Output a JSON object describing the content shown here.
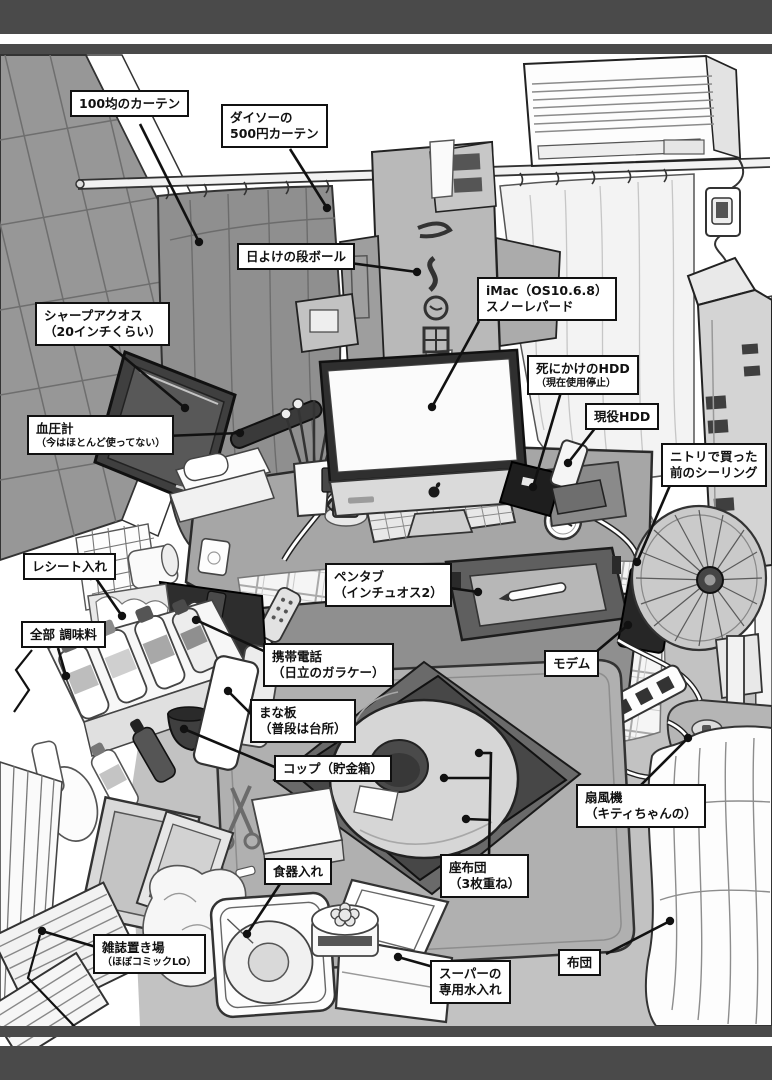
{
  "illustration_subject": "部屋の机まわり（注釈付きイラスト）",
  "colors": {
    "ink": "#111111",
    "panel_bar": "#4a4a4a",
    "paper": "#ffffff",
    "mid_gray": "#a6a6a6"
  },
  "labels": [
    {
      "id": "curtain-100yen",
      "lines": [
        "100均のカーテン"
      ]
    },
    {
      "id": "daiso-curtain",
      "lines": [
        "ダイソーの",
        "500円カーテン"
      ]
    },
    {
      "id": "sunshade-cardboard",
      "lines": [
        "日よけの段ボール"
      ]
    },
    {
      "id": "sharp-aquos",
      "lines": [
        "シャープアクオス",
        "（20インチくらい）"
      ]
    },
    {
      "id": "blood-pressure",
      "lines": [
        "血圧計",
        "（今はほとんど使ってない）"
      ]
    },
    {
      "id": "imac",
      "lines": [
        "iMac（OS10.6.8）",
        "スノーレパード"
      ]
    },
    {
      "id": "dying-hdd",
      "lines": [
        "死にかけのHDD",
        "（現在使用停止）"
      ]
    },
    {
      "id": "active-hdd",
      "lines": [
        "現役HDD"
      ]
    },
    {
      "id": "nitori-ceiling",
      "lines": [
        "ニトリで買った",
        "前のシーリング"
      ]
    },
    {
      "id": "receipt-holder",
      "lines": [
        "レシート入れ"
      ]
    },
    {
      "id": "condiments",
      "lines": [
        "全部 調味料"
      ]
    },
    {
      "id": "pen-tablet",
      "lines": [
        "ペンタブ",
        "（インチュオス2）"
      ]
    },
    {
      "id": "mobile-phone",
      "lines": [
        "携帯電話",
        "（日立のガラケー）"
      ]
    },
    {
      "id": "modem",
      "lines": [
        "モデム"
      ]
    },
    {
      "id": "cutting-board",
      "lines": [
        "まな板",
        "（普段は台所）"
      ]
    },
    {
      "id": "cup-piggy-bank",
      "lines": [
        "コップ（貯金箱）"
      ]
    },
    {
      "id": "fan",
      "lines": [
        "扇風機",
        "（キティちゃんの）"
      ]
    },
    {
      "id": "dish-container",
      "lines": [
        "食器入れ"
      ]
    },
    {
      "id": "zabuton",
      "lines": [
        "座布団",
        "（3枚重ね）"
      ]
    },
    {
      "id": "magazine-storage",
      "lines": [
        "雑誌置き場",
        "（ほぼコミックLO）"
      ]
    },
    {
      "id": "water-jug",
      "lines": [
        "スーパーの",
        "専用水入れ"
      ]
    },
    {
      "id": "futon",
      "lines": [
        "布団"
      ]
    }
  ]
}
